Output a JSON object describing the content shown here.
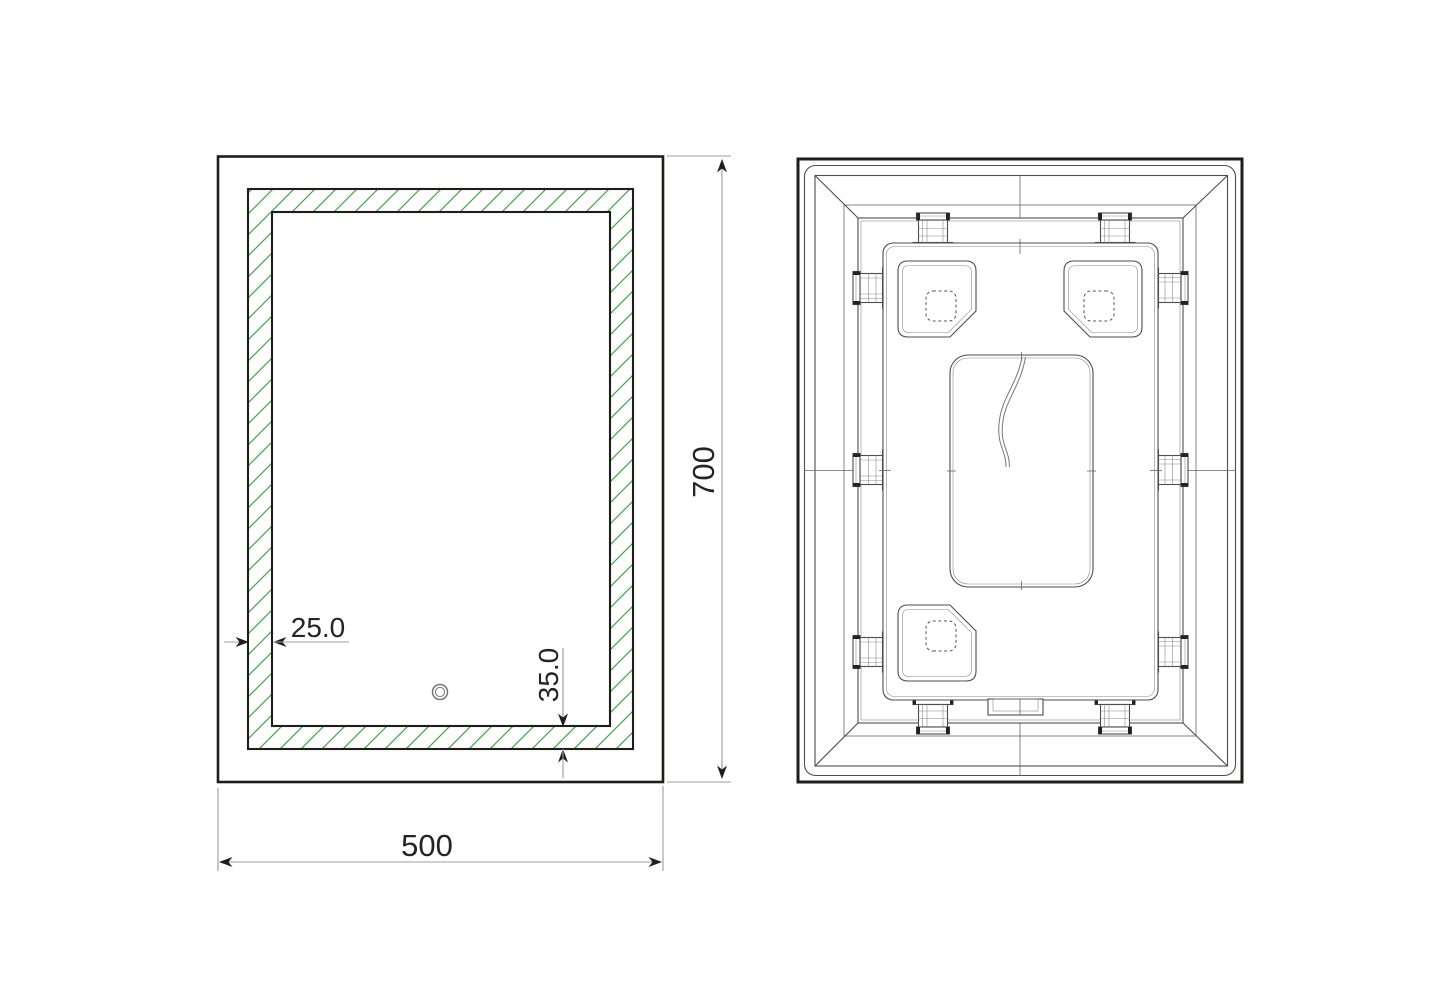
{
  "drawing": {
    "front": {
      "dimensions": {
        "border_width": "25.0",
        "sensor_offset": "35.0",
        "width": "500",
        "height": "700"
      }
    },
    "colors": {
      "outline": "#1d1d1b",
      "thin_line": "#4d4d4d",
      "dimension": "#9c9c9c",
      "hatch_green": "#4aa851",
      "background": "#ffffff"
    }
  }
}
